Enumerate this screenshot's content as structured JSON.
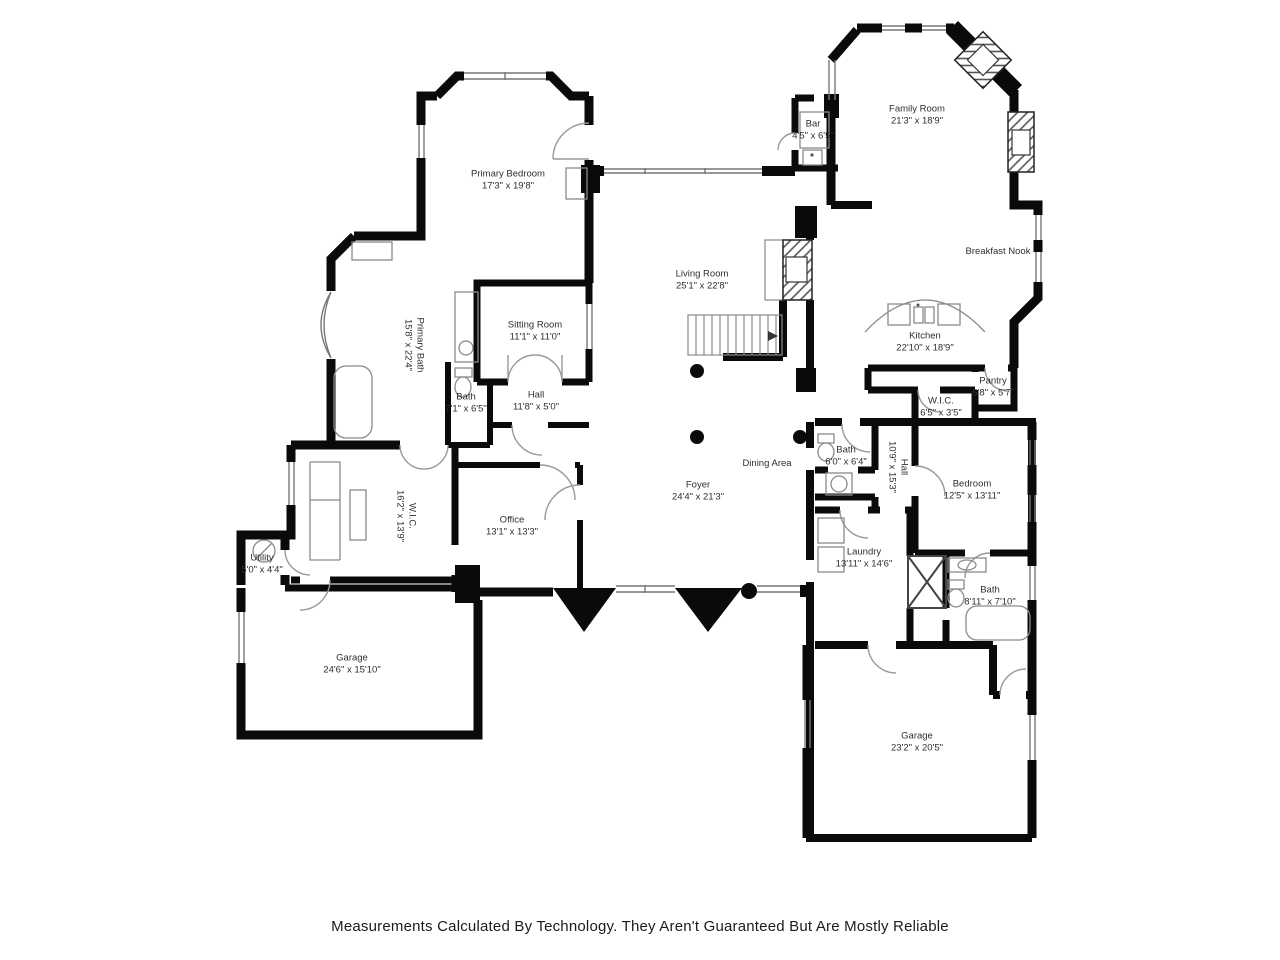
{
  "colors": {
    "wall": "#0a0a0a",
    "fixture": "#9a9a9a",
    "label": "#2e2e2e"
  },
  "floorplan": {
    "rooms": [
      {
        "name": "Family Room",
        "dims": "21'3\" x 18'9\""
      },
      {
        "name": "Bar",
        "dims": "4'5\" x 6'5\""
      },
      {
        "name": "Primary Bedroom",
        "dims": "17'3\" x 19'8\""
      },
      {
        "name": "Living Room",
        "dims": "25'1\" x 22'8\""
      },
      {
        "name": "Sitting Room",
        "dims": "11'1\" x 11'0\""
      },
      {
        "name": "Primary Bath",
        "dims": "15'8\" x 22'4\""
      },
      {
        "name": "Breakfast Nook",
        "dims": ""
      },
      {
        "name": "Kitchen",
        "dims": "22'10\" x 18'9\""
      },
      {
        "name": "Pantry",
        "dims": "5'8\" x 5'7\""
      },
      {
        "name": "W.I.C.",
        "dims": "6'5\" x 3'5\""
      },
      {
        "name": "Bath",
        "dims": "7'1\" x 6'5\""
      },
      {
        "name": "Hall",
        "dims": "11'8\" x 5'0\""
      },
      {
        "name": "Bath",
        "dims": "6'0\" x 6'4\""
      },
      {
        "name": "Hall",
        "dims": "10'9\" x 15'3\""
      },
      {
        "name": "Bedroom",
        "dims": "12'5\" x 13'11\""
      },
      {
        "name": "Dining Area",
        "dims": ""
      },
      {
        "name": "Foyer",
        "dims": "24'4\" x 21'3\""
      },
      {
        "name": "Office",
        "dims": "13'1\" x 13'3\""
      },
      {
        "name": "W.I.C.",
        "dims": "16'2\" x 13'9\""
      },
      {
        "name": "Utility",
        "dims": "5'0\" x 4'4\""
      },
      {
        "name": "Garage",
        "dims": "24'6\" x 15'10\""
      },
      {
        "name": "Laundry",
        "dims": "13'11\" x 14'6\""
      },
      {
        "name": "Bath",
        "dims": "8'11\" x 7'10\""
      },
      {
        "name": "Garage",
        "dims": "23'2\" x 20'5\""
      }
    ]
  },
  "footer": {
    "disclaimer": "Measurements Calculated By Technology. They Aren't Guaranteed But Are Mostly Reliable"
  }
}
